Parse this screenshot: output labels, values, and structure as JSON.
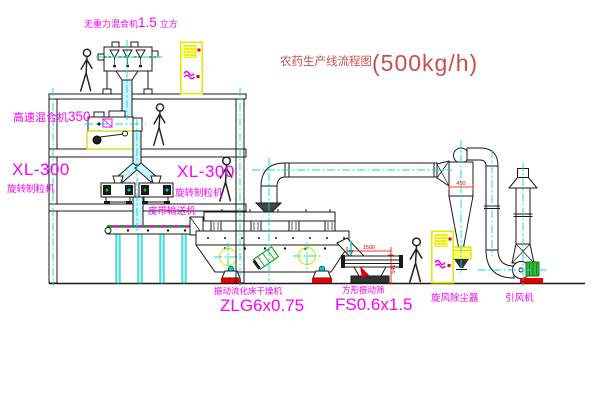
{
  "drawing": {
    "title_text": "农药生产线流程图",
    "title_capacity": "(500kg/h)"
  },
  "equipment": {
    "zero_gravity_mixer": {
      "name": "无重力混合机",
      "size": "1.5",
      "unit": "立方"
    },
    "high_speed_mixer": {
      "name": "高速混合机",
      "model": "350"
    },
    "granulator_left": {
      "model": "XL-300",
      "name": "旋转制粒机"
    },
    "granulator_right": {
      "model": "XL-300",
      "name": "旋转制粒机"
    },
    "belt_conveyor": {
      "name": "皮带输送机"
    },
    "fluid_bed_dryer": {
      "name": "振动流化床干燥机",
      "model": "ZLG6x0.75"
    },
    "vibrating_screen": {
      "name": "方形振动筛",
      "model": "FS0.6x1.5"
    },
    "cyclone": {
      "name": "旋风除尘器"
    },
    "fan": {
      "name": "引风机"
    }
  },
  "dimensions": {
    "cyclone_inlet": "450",
    "screen_length": "1500",
    "screen_height": "541"
  },
  "colors": {
    "label_magenta": "#ff00ff",
    "title_red": "#c94f4f",
    "dimension_red": "#e60000",
    "centerline_cyan": "#00dcdc",
    "cabinet_yellow": "#e8e800",
    "target_yellow": "#e6e600",
    "motor_green": "#089f08",
    "line_black": "#1a1a1a"
  }
}
